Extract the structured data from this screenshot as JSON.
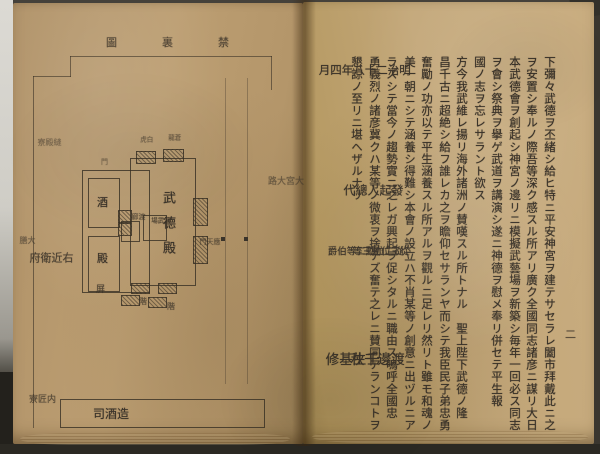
{
  "photo": {
    "paper_color_left": "#bc9e72",
    "paper_color_right": "#c3a779",
    "ink_color": "#3a332a",
    "backdrop_color": "#45413a",
    "left_strip_color": "#cfcdc6"
  },
  "left_page": {
    "plate_title": {
      "label": "禁裏圖",
      "display_chars": [
        "圖",
        "裏",
        "禁"
      ]
    },
    "diagram": {
      "street_label": "大宮大路",
      "offices": {
        "nuidono": "縫殿寮",
        "daizen": "大膳",
        "ukonoe": "右近衛府",
        "takumi": "内匠寮",
        "miki": {
          "label": "造酒司",
          "display": "司酒造"
        }
      },
      "court": {
        "hall": {
          "label": "武德殿",
          "display": "武德殿"
        },
        "inner_hall": "演武場",
        "tower_left": "白虎",
        "tower_right": "蒼龍",
        "gate": "應天門",
        "side_gate": "門",
        "stair_a": "階",
        "stair_b": "階",
        "screen": "屏"
      },
      "west_halls": {
        "upper": "酒",
        "lower": "殿",
        "corridor": "渡廊"
      }
    }
  },
  "right_page": {
    "page_number": "二",
    "columns": [
      "下彌々武德ヲ丕緒シ給ヒ特ニ平安神宮ヲ建テサセラレ闔市拜戴此ニ之",
      "ヲ安置シ奉ルノ際吾等深ク感スル所アリ廣ク全國同志諸彦ニ謀リ大日",
      "本武德會ヲ創起シ神宮ノ邊リニ模擬武藝場ヲ新築シ毎年一回必ス同志",
      "ヲ會シ祭典ヲ擧ゲ武道ヲ講演シ遂ニ神德ヲ慰メ奉リ併セテ平生報",
      "國ノ志ヲ忘レサラント欲ス",
      "方今我武維レ揚リ海外諸洲ノ賛嘆スル所トナル　聖上陛下武德ノ隆",
      "昌千古ニ超絶シ給フ誰レカ之ヲ瞻仰セサランヤ而シテ我臣民子弟忠勇",
      "奮勵ノ功亦以テ平生涵養スル所アルヲ觀ルニ足レリ然リト雖モ和魂ノ",
      "美一朝ニシテ涵養シ得難シ本會ノ設立ハ不肖某等ノ創意ニ出ヅルニア",
      "ラズシテ當今ノ趨勢實ニ之レガ興起ヲ促シタルニ職由ス嗚呼全國忠",
      "勇義烈ノ諸彦冀クハ某等ノ微衷ヲ捨テズ奮テ之レニ賛同アランコトヲ",
      "懇諒ノ至リニ堪ヘザルナリ"
    ],
    "date_line": "明治二十八年四月",
    "signatory_heading": "發起人總代",
    "signatories": [
      {
        "rank": "從三位勳三等",
        "name": "渡邊千秋"
      },
      {
        "rank": "從二位勳二等伯爵",
        "name": "壬生基修"
      }
    ]
  }
}
